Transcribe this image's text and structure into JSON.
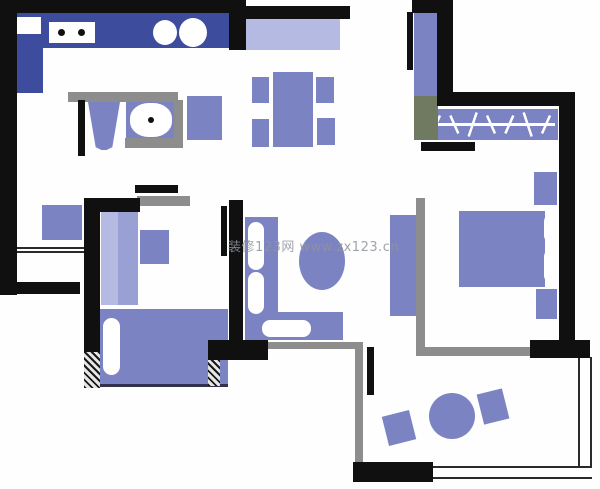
{
  "canvas": {
    "width": 600,
    "height": 489
  },
  "watermark": {
    "text": "装修123网  www.zx123.cn",
    "color": "#8f949e"
  },
  "palette": {
    "wall": "#101010",
    "gray": "#8d8d8d",
    "gray_green": "#6f7a60",
    "furniture": "#7b83c3",
    "furniture_mid": "#99a0d3",
    "furniture_light": "#b4bae1",
    "navy": "#3e4c9e",
    "white": "#ffffff",
    "dark_edge": "#32324e"
  },
  "elements": [
    {
      "name": "kitchen-counter-top",
      "x": 40,
      "y": 13,
      "w": 192,
      "h": 35,
      "color": "navy"
    },
    {
      "name": "kitchen-counter-left",
      "x": 13,
      "y": 13,
      "w": 30,
      "h": 80,
      "color": "navy"
    },
    {
      "name": "kitchen-appliance",
      "x": 13,
      "y": 17,
      "w": 28,
      "h": 17,
      "color": "white"
    },
    {
      "name": "kitchen-stove",
      "x": 49,
      "y": 22,
      "w": 46,
      "h": 21,
      "color": "white"
    },
    {
      "name": "stove-burner-left",
      "x": 58,
      "y": 29,
      "w": 7,
      "h": 7,
      "color": "wall",
      "round": "50%"
    },
    {
      "name": "stove-burner-right",
      "x": 78,
      "y": 29,
      "w": 7,
      "h": 7,
      "color": "wall",
      "round": "50%"
    },
    {
      "name": "sink-basin-left",
      "x": 153,
      "y": 20,
      "w": 24,
      "h": 25,
      "color": "white",
      "round": "50%"
    },
    {
      "name": "sink-basin-right",
      "x": 179,
      "y": 18,
      "w": 28,
      "h": 29,
      "color": "white",
      "round": "50%"
    },
    {
      "name": "toilet",
      "x": 88,
      "y": 102,
      "w": 32,
      "h": 48,
      "color": "furniture",
      "clip": "polygon(0% 0%, 100% 0%, 76% 94%, 58% 100%, 42% 100%, 24% 94%)"
    },
    {
      "name": "washbasin-counter",
      "x": 126,
      "y": 100,
      "w": 50,
      "h": 40,
      "color": "furniture"
    },
    {
      "name": "washbasin-bowl",
      "x": 130,
      "y": 103,
      "w": 42,
      "h": 34,
      "color": "white",
      "round": "45%"
    },
    {
      "name": "washbasin-drain",
      "x": 148,
      "y": 117,
      "w": 6,
      "h": 6,
      "color": "wall",
      "round": "50%"
    },
    {
      "name": "washing-machine",
      "x": 187,
      "y": 96,
      "w": 35,
      "h": 44,
      "color": "furniture"
    },
    {
      "name": "entry-cabinet",
      "x": 245,
      "y": 19,
      "w": 95,
      "h": 31,
      "color": "furniture_light"
    },
    {
      "name": "dining-table",
      "x": 273,
      "y": 72,
      "w": 40,
      "h": 75,
      "color": "furniture"
    },
    {
      "name": "dining-chair-top-left",
      "x": 252,
      "y": 77,
      "w": 17,
      "h": 26,
      "color": "furniture"
    },
    {
      "name": "dining-chair-bottom-left",
      "x": 252,
      "y": 119,
      "w": 17,
      "h": 28,
      "color": "furniture"
    },
    {
      "name": "dining-chair-top-right",
      "x": 316,
      "y": 77,
      "w": 18,
      "h": 26,
      "color": "furniture"
    },
    {
      "name": "dining-chair-bottom-right",
      "x": 317,
      "y": 118,
      "w": 18,
      "h": 27,
      "color": "furniture"
    },
    {
      "name": "hall-cabinet",
      "x": 42,
      "y": 205,
      "w": 40,
      "h": 35,
      "color": "furniture"
    },
    {
      "name": "bedroom2-wardrobe-light",
      "x": 101,
      "y": 211,
      "w": 17,
      "h": 94,
      "color": "furniture_light"
    },
    {
      "name": "bedroom2-wardrobe-dark",
      "x": 118,
      "y": 211,
      "w": 20,
      "h": 94,
      "color": "furniture_mid"
    },
    {
      "name": "bedroom2-desk",
      "x": 140,
      "y": 230,
      "w": 29,
      "h": 34,
      "color": "furniture"
    },
    {
      "name": "bedroom2-bed",
      "x": 100,
      "y": 309,
      "w": 128,
      "h": 78,
      "color": "furniture",
      "cls": "bed-edge"
    },
    {
      "name": "bedroom2-pillow",
      "x": 103,
      "y": 318,
      "w": 17,
      "h": 57,
      "color": "white",
      "round": "9px"
    },
    {
      "name": "sofa-vertical",
      "x": 245,
      "y": 217,
      "w": 33,
      "h": 123,
      "color": "furniture"
    },
    {
      "name": "sofa-horizontal",
      "x": 245,
      "y": 312,
      "w": 98,
      "h": 28,
      "color": "furniture"
    },
    {
      "name": "sofa-cushion-top",
      "x": 248,
      "y": 222,
      "w": 16,
      "h": 48,
      "color": "white",
      "round": "8px"
    },
    {
      "name": "sofa-cushion-middle",
      "x": 248,
      "y": 272,
      "w": 16,
      "h": 42,
      "color": "white",
      "round": "8px"
    },
    {
      "name": "sofa-cushion-bottom",
      "x": 262,
      "y": 320,
      "w": 49,
      "h": 17,
      "color": "white",
      "round": "8px"
    },
    {
      "name": "coffee-table",
      "x": 299,
      "y": 232,
      "w": 46,
      "h": 58,
      "color": "furniture",
      "round": "50%"
    },
    {
      "name": "tv-cabinet",
      "x": 390,
      "y": 215,
      "w": 27,
      "h": 101,
      "color": "furniture"
    },
    {
      "name": "closet-unit-vertical",
      "x": 414,
      "y": 13,
      "w": 23,
      "h": 84,
      "color": "furniture"
    },
    {
      "name": "wardrobe-rail",
      "x": 424,
      "y": 109,
      "w": 134,
      "h": 31,
      "color": "furniture",
      "rail": 7
    },
    {
      "name": "master-bed",
      "x": 459,
      "y": 211,
      "w": 86,
      "h": 76,
      "color": "furniture"
    },
    {
      "name": "master-pillow-top",
      "x": 544,
      "y": 214,
      "w": 15,
      "h": 29,
      "color": "white",
      "round": "8px"
    },
    {
      "name": "master-pillow-bottom",
      "x": 544,
      "y": 249,
      "w": 15,
      "h": 34,
      "color": "white",
      "round": "8px"
    },
    {
      "name": "master-nightstand-top",
      "x": 534,
      "y": 172,
      "w": 23,
      "h": 33,
      "color": "furniture"
    },
    {
      "name": "master-nightstand-bottom",
      "x": 536,
      "y": 289,
      "w": 21,
      "h": 30,
      "color": "furniture"
    },
    {
      "name": "balcony-table",
      "x": 429,
      "y": 393,
      "w": 46,
      "h": 46,
      "color": "furniture",
      "round": "50%"
    },
    {
      "name": "balcony-chair-left",
      "x": 385,
      "y": 413,
      "w": 28,
      "h": 30,
      "color": "furniture",
      "rotate": -14
    },
    {
      "name": "balcony-chair-right",
      "x": 480,
      "y": 391,
      "w": 26,
      "h": 31,
      "color": "furniture",
      "rotate": -14
    },
    {
      "name": "bathroom-frame-top",
      "x": 68,
      "y": 92,
      "w": 110,
      "h": 10,
      "color": "gray"
    },
    {
      "name": "bathroom-frame-right",
      "x": 174,
      "y": 100,
      "w": 9,
      "h": 48,
      "color": "gray"
    },
    {
      "name": "bathroom-frame-bottom",
      "x": 125,
      "y": 138,
      "w": 58,
      "h": 10,
      "color": "gray"
    },
    {
      "name": "bedroom2-doorframe",
      "x": 137,
      "y": 196,
      "w": 53,
      "h": 10,
      "color": "gray"
    },
    {
      "name": "balcony-wall-horizontal",
      "x": 262,
      "y": 342,
      "w": 98,
      "h": 7,
      "color": "gray"
    },
    {
      "name": "balcony-wall-vertical",
      "x": 355,
      "y": 342,
      "w": 8,
      "h": 122,
      "color": "gray"
    },
    {
      "name": "master-wall-vertical",
      "x": 416,
      "y": 198,
      "w": 9,
      "h": 149,
      "color": "gray"
    },
    {
      "name": "master-wall-horizontal",
      "x": 416,
      "y": 347,
      "w": 114,
      "h": 9,
      "color": "gray"
    },
    {
      "name": "closet-corner",
      "x": 414,
      "y": 96,
      "w": 24,
      "h": 44,
      "color": "gray_green"
    },
    {
      "name": "storage-window",
      "x": 8,
      "y": 247,
      "w": 76,
      "h": 6,
      "cls": "dbl-h"
    },
    {
      "name": "balcony-edge-right",
      "x": 578,
      "y": 357,
      "w": 14,
      "h": 122,
      "cls": "dbl-v"
    },
    {
      "name": "balcony-edge-bottom",
      "x": 430,
      "y": 466,
      "w": 162,
      "h": 13,
      "cls": "dbl-h"
    },
    {
      "name": "wall-top-left",
      "x": 0,
      "y": 0,
      "w": 232,
      "h": 13,
      "color": "wall"
    },
    {
      "name": "wall-entry-stub",
      "x": 229,
      "y": 0,
      "w": 17,
      "h": 50,
      "color": "wall"
    },
    {
      "name": "wall-top-mid",
      "x": 245,
      "y": 6,
      "w": 105,
      "h": 13,
      "color": "wall"
    },
    {
      "name": "wall-left",
      "x": 0,
      "y": 0,
      "w": 17,
      "h": 295,
      "color": "wall"
    },
    {
      "name": "wall-storage-bottom",
      "x": 0,
      "y": 282,
      "w": 80,
      "h": 12,
      "color": "wall"
    },
    {
      "name": "wall-bedroom2-left",
      "x": 84,
      "y": 198,
      "w": 16,
      "h": 158,
      "color": "wall"
    },
    {
      "name": "wall-bedroom2-top",
      "x": 84,
      "y": 198,
      "w": 56,
      "h": 14,
      "color": "wall"
    },
    {
      "name": "door-bedroom2-leaf",
      "x": 135,
      "y": 185,
      "w": 43,
      "h": 8,
      "color": "wall"
    },
    {
      "name": "wall-center",
      "x": 229,
      "y": 200,
      "w": 14,
      "h": 145,
      "color": "wall"
    },
    {
      "name": "door-bedroom2-inner-leaf",
      "x": 221,
      "y": 206,
      "w": 6,
      "h": 50,
      "color": "wall"
    },
    {
      "name": "wall-living-bottom",
      "x": 208,
      "y": 340,
      "w": 60,
      "h": 20,
      "color": "wall"
    },
    {
      "name": "door-bathroom-leaf",
      "x": 78,
      "y": 100,
      "w": 7,
      "h": 56,
      "color": "wall"
    },
    {
      "name": "door-entry-leaf",
      "x": 407,
      "y": 12,
      "w": 6,
      "h": 58,
      "color": "wall"
    },
    {
      "name": "wall-closet-top",
      "x": 412,
      "y": 0,
      "w": 41,
      "h": 13,
      "color": "wall"
    },
    {
      "name": "wall-closet-left",
      "x": 437,
      "y": 0,
      "w": 16,
      "h": 104,
      "color": "wall"
    },
    {
      "name": "wall-closet-bottom",
      "x": 437,
      "y": 92,
      "w": 138,
      "h": 14,
      "color": "wall"
    },
    {
      "name": "wall-right",
      "x": 559,
      "y": 97,
      "w": 16,
      "h": 246,
      "color": "wall"
    },
    {
      "name": "wall-master-bottom",
      "x": 530,
      "y": 340,
      "w": 60,
      "h": 18,
      "color": "wall"
    },
    {
      "name": "closet-door-bar",
      "x": 421,
      "y": 142,
      "w": 54,
      "h": 9,
      "color": "wall"
    },
    {
      "name": "door-balcony-leaf",
      "x": 367,
      "y": 347,
      "w": 7,
      "h": 48,
      "color": "wall"
    },
    {
      "name": "wall-balcony-bottom",
      "x": 353,
      "y": 462,
      "w": 80,
      "h": 20,
      "color": "wall"
    },
    {
      "name": "hatch-bedroom2-window",
      "x": 84,
      "y": 352,
      "w": 16,
      "h": 36,
      "cls": "hatch"
    },
    {
      "name": "hatch-living-window",
      "x": 208,
      "y": 360,
      "w": 12,
      "h": 26,
      "cls": "hatch"
    }
  ]
}
